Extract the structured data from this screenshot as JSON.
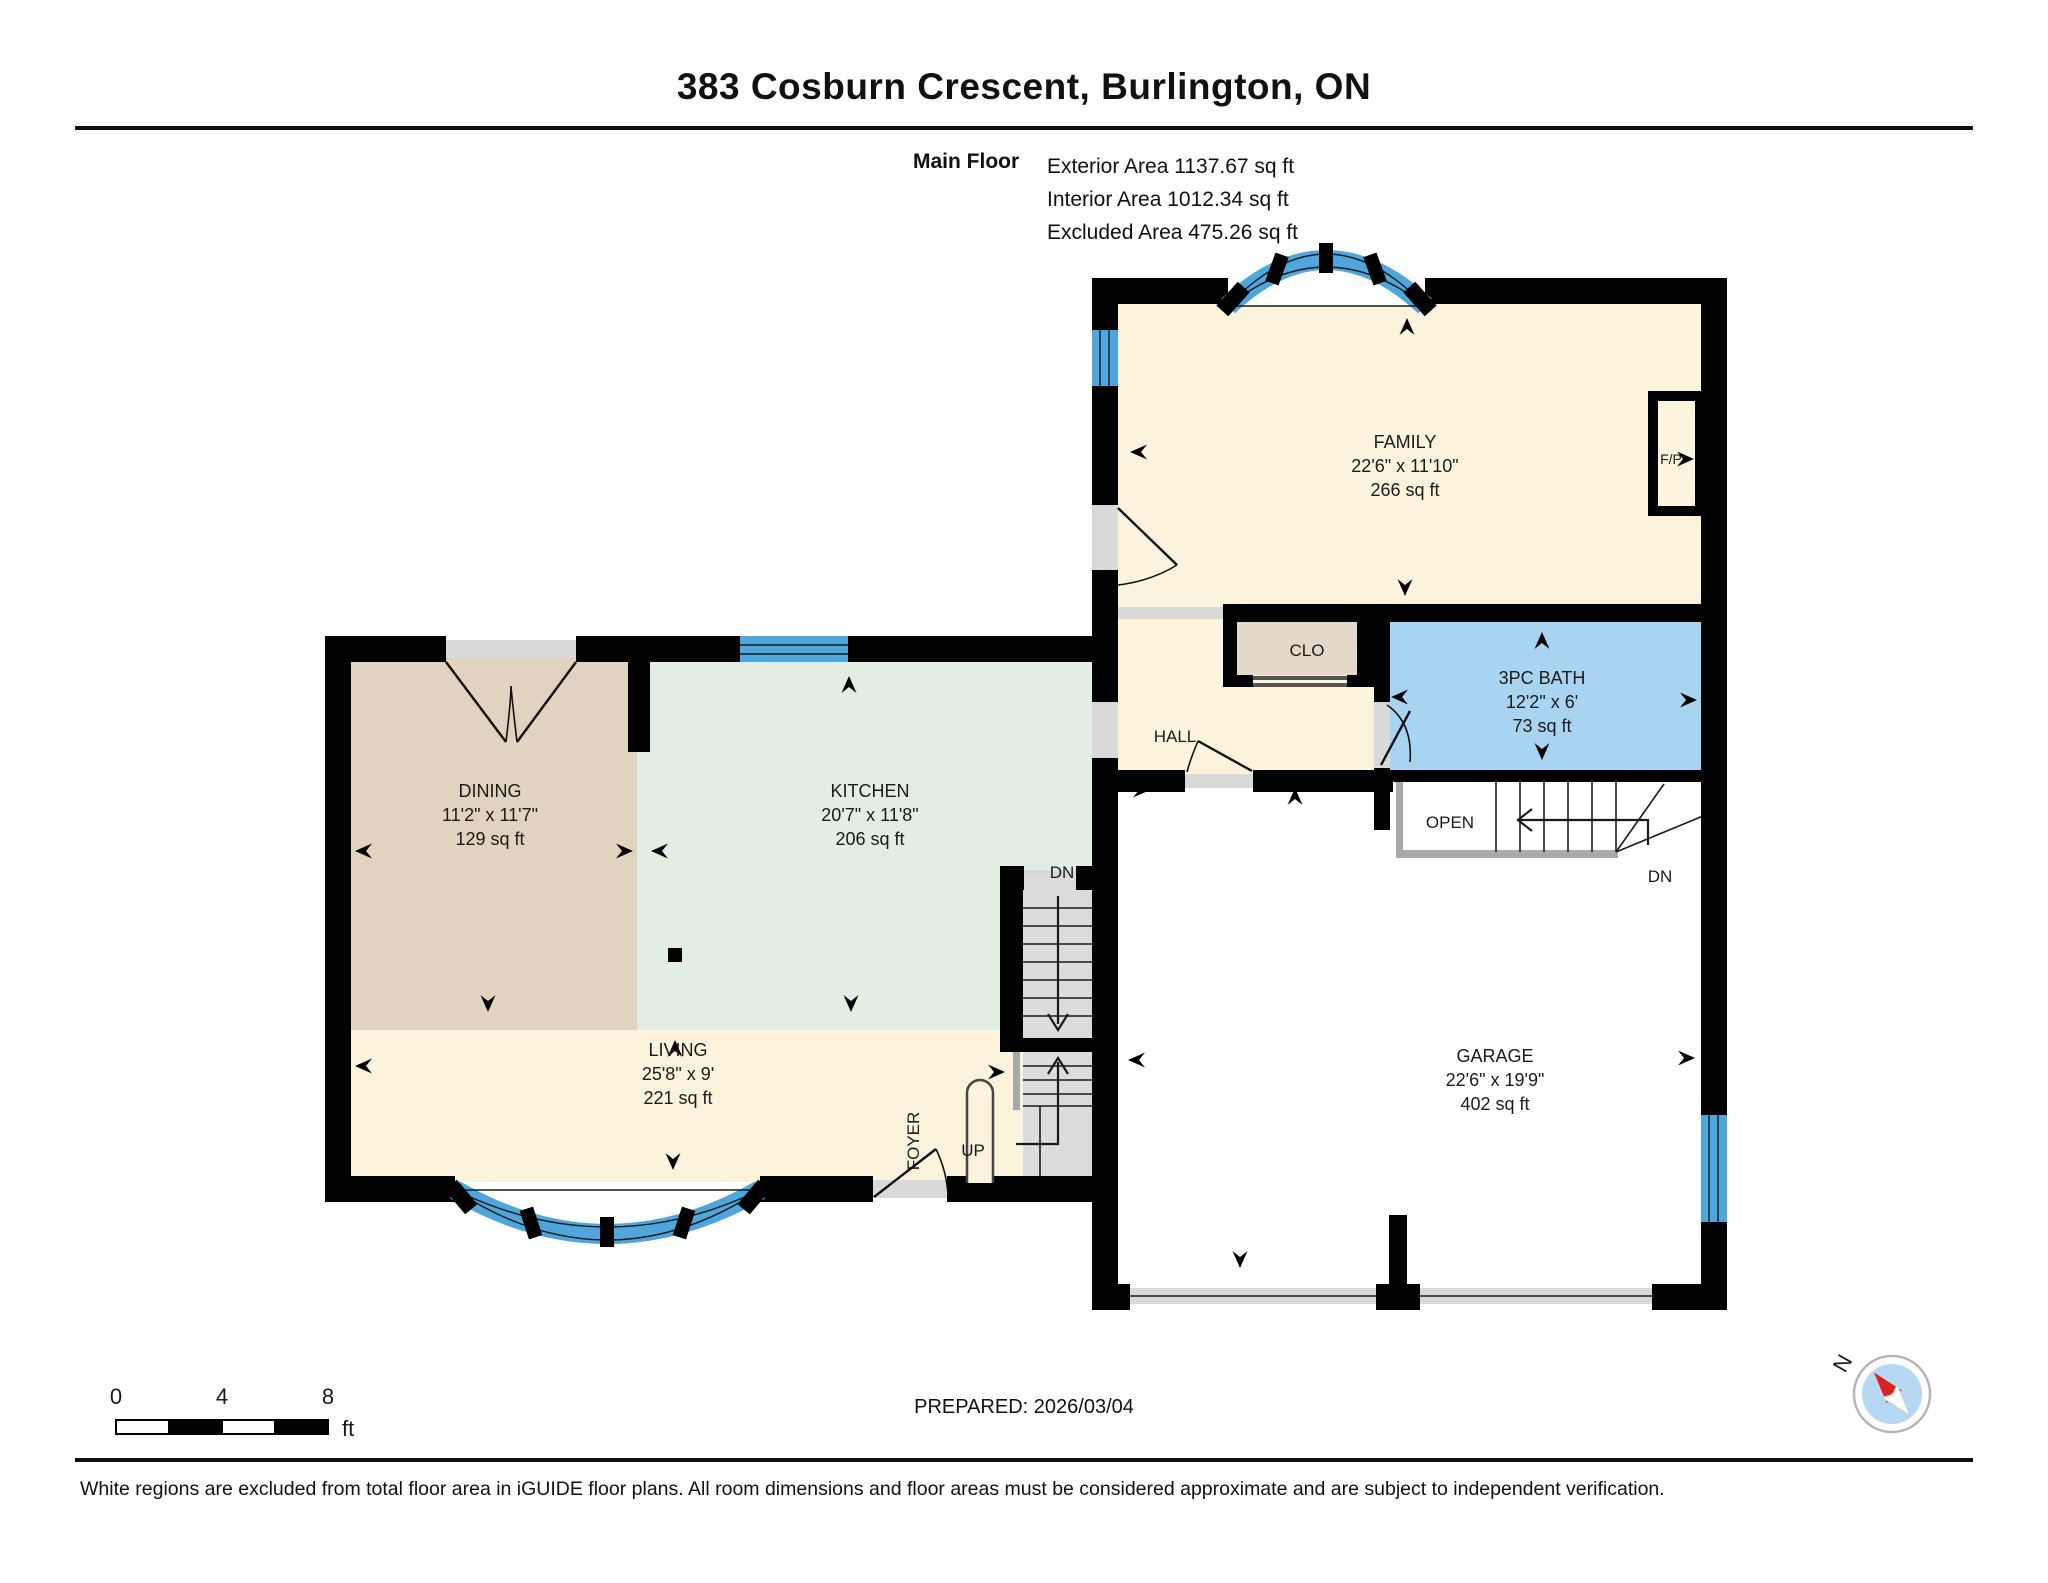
{
  "header": {
    "title": "383 Cosburn Crescent, Burlington, ON",
    "floor_label": "Main Floor",
    "exterior_area": "Exterior Area 1137.67 sq ft",
    "interior_area": "Interior Area 1012.34 sq ft",
    "excluded_area": "Excluded Area 475.26 sq ft"
  },
  "rooms": {
    "family": {
      "name": "FAMILY",
      "dims": "22'6\" x 11'10\"",
      "area": "266 sq ft"
    },
    "dining": {
      "name": "DINING",
      "dims": "11'2\" x 11'7\"",
      "area": "129 sq ft"
    },
    "kitchen": {
      "name": "KITCHEN",
      "dims": "20'7\" x 11'8\"",
      "area": "206 sq ft"
    },
    "living": {
      "name": "LIVING",
      "dims": "25'8\" x 9'",
      "area": "221 sq ft"
    },
    "bath": {
      "name": "3PC BATH",
      "dims": "12'2\" x 6'",
      "area": "73 sq ft"
    },
    "garage": {
      "name": "GARAGE",
      "dims": "22'6\" x 19'9\"",
      "area": "402 sq ft"
    },
    "hall": {
      "name": "HALL"
    },
    "closet": {
      "name": "CLO"
    },
    "foyer": {
      "name": "FOYER"
    }
  },
  "labels": {
    "open": "OPEN",
    "down_right": "DN",
    "down_center": "DN",
    "up": "UP",
    "fireplace": "F/P"
  },
  "scale_bar": {
    "tick0": "0",
    "tick4": "4",
    "tick8": "8",
    "unit": "ft"
  },
  "compass": {
    "north": "N"
  },
  "footer": {
    "prepared": "PREPARED: 2026/03/04",
    "disclaimer": "White regions are excluded from total floor area in iGUIDE floor plans. All room dimensions and floor areas must be considered approximate and are subject to independent verification."
  },
  "colors": {
    "wall": "#000000",
    "cream": "#FBF3DC",
    "dining_fill": "#E0D3BF",
    "kitchen_fill": "#E2EDE3",
    "bath_fill": "#A8D4F2",
    "closet_fill": "#E4D9C8",
    "window": "#4FA6DC",
    "compass_red": "#E02020",
    "compass_blue": "#B5D9F2"
  }
}
